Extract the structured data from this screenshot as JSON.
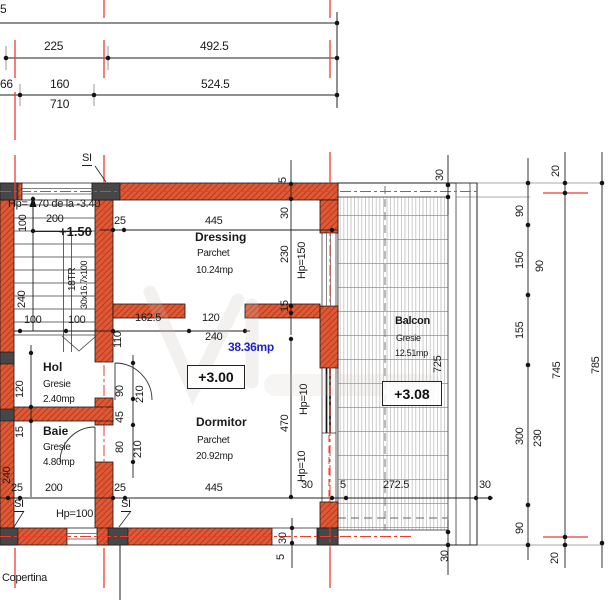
{
  "colors": {
    "wall": "#de5a37",
    "wall_hatch": "#b93d1d",
    "axis_red": "#f23b2e",
    "column_dark": "#474747",
    "dim_text": "#1a1a1a",
    "area_blue": "#1f1fd0"
  },
  "top_dims": {
    "cut": "5",
    "r1_a": "225",
    "r1_b": "492.5",
    "r2_a": "66",
    "r2_b": "160",
    "r2_c": "524.5",
    "total": "710"
  },
  "stair": {
    "marker": "SI",
    "hp_prefix": "Hp=",
    "hp_note": "70 de la -3.40",
    "w100": "100",
    "w200": "200",
    "level": "+1.50",
    "treads": "18TR",
    "tread_size": "30x16.7x100",
    "h240": "240",
    "t100a": "100",
    "t100b": "100"
  },
  "dressing": {
    "name": "Dressing",
    "finish": "Parchet",
    "area": "10.24mp",
    "d25": "25",
    "d445": "445",
    "w5": "5",
    "w30": "30",
    "h230": "230",
    "h15": "15",
    "parapet": "Hp=150"
  },
  "living": {
    "d162_5": "162.5",
    "d120": "120",
    "d240": "240",
    "total_area": "38.36mp",
    "level": "+3.00",
    "h110": "110",
    "door90": "90",
    "leaf210a": "210",
    "h45": "45",
    "door80": "80",
    "leaf210b": "210"
  },
  "dormitor": {
    "name": "Dormitor",
    "finish": "Parchet",
    "area": "20.92mp",
    "h470": "470",
    "parapet_a": "Hp=10",
    "parapet_b": "Hp=10"
  },
  "hol": {
    "name": "Hol",
    "finish": "Gresie",
    "area": "2.40mp",
    "h120": "120"
  },
  "baie": {
    "name": "Baie",
    "finish": "Gresie",
    "area": "4.80mp",
    "h15": "15",
    "h240": "240"
  },
  "balcon": {
    "name": "Balcon",
    "finish": "Gresie",
    "area": "12.51mp",
    "level": "+3.08",
    "h725": "725",
    "slab30_top": "30",
    "slab30_bottom": "30",
    "d272_5": "272.5",
    "d30_right": "30",
    "wall30": "30",
    "wall5": "5"
  },
  "bottom": {
    "d25a": "25",
    "d200": "200",
    "d25b": "25",
    "d445": "445",
    "d30": "30",
    "d5": "5",
    "si_a": "SI",
    "si_b": "SI",
    "parapet": "Hp=100",
    "note": "Copertina"
  },
  "right_dims": {
    "g20a": "20",
    "g90a": "90",
    "g150": "150",
    "g90b": "90",
    "g155": "155",
    "g300": "300",
    "g230": "230",
    "g90c": "90",
    "g20b": "20",
    "total745": "745",
    "total785": "785"
  }
}
